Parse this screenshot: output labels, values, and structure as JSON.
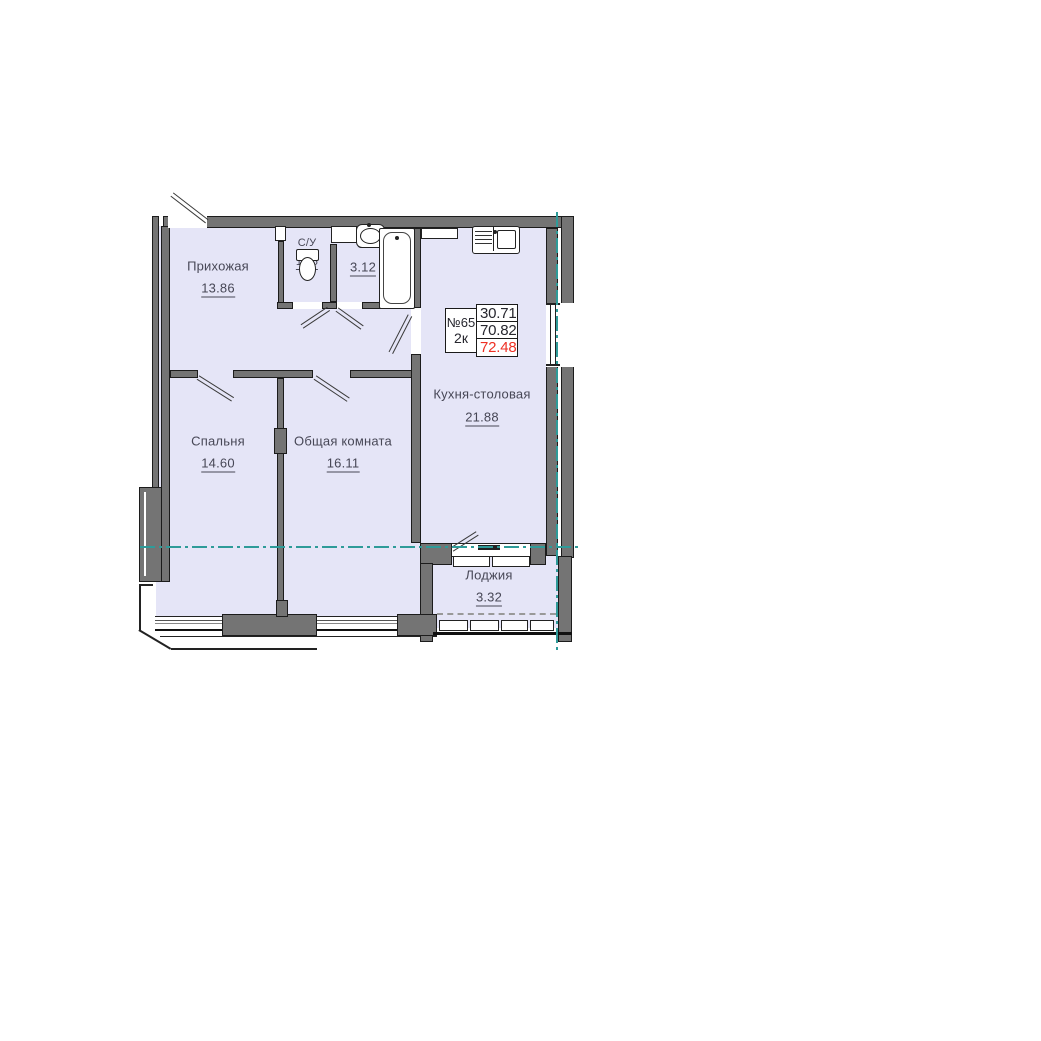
{
  "unit_card": {
    "number": "№65",
    "rooms_count": "2к",
    "living_area": "30.71",
    "area_without_loggia": "70.82",
    "total_area": "72.48"
  },
  "rooms": [
    {
      "name": "Прихожая",
      "area": "13.86"
    },
    {
      "name": "С/У",
      "area": "1.25"
    },
    {
      "name": "С/У",
      "area": "3.12"
    },
    {
      "name": "Кухня-столовая",
      "area": "21.88"
    },
    {
      "name": "Спальня",
      "area": "14.60"
    },
    {
      "name": "Общая комната",
      "area": "16.11"
    },
    {
      "name": "Лоджия",
      "area": "3.32"
    }
  ],
  "colors": {
    "room_fill": "#e5e5f7",
    "wall": "#747474",
    "wall_outline": "#1c1c1c",
    "axis_line": "#2e9b99",
    "total_area_highlight": "#ee3024",
    "label_text": "#474756"
  }
}
